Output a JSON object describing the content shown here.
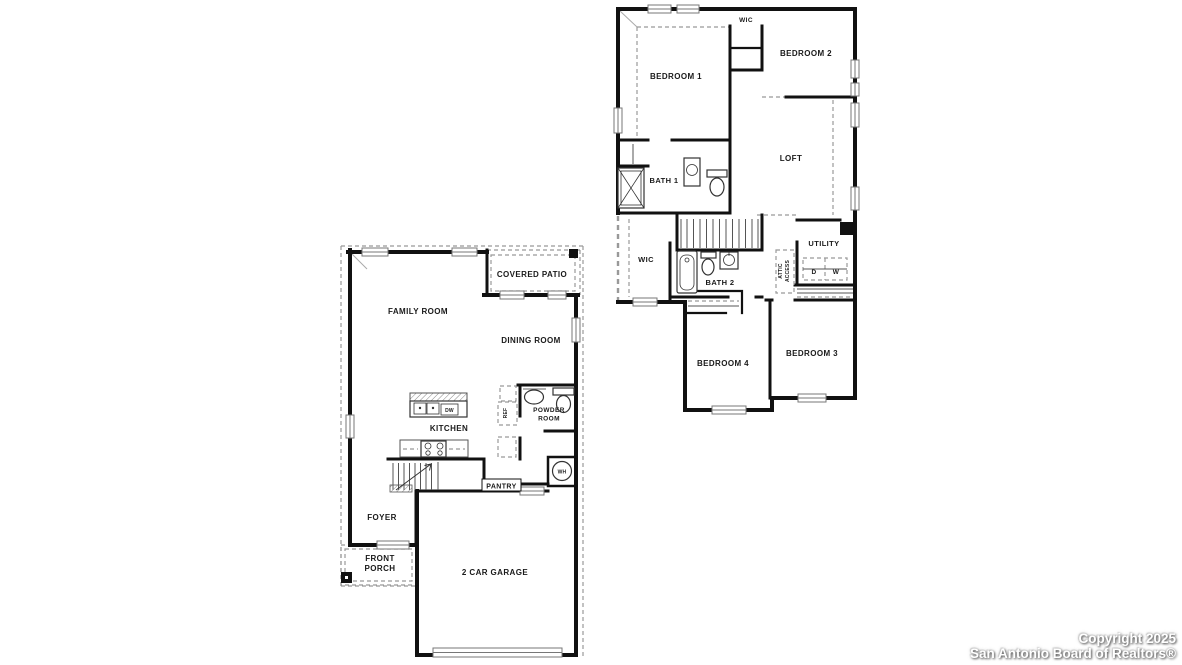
{
  "watermark": {
    "line1": "Copyright 2025",
    "line2": "San Antonio Board of Realtors®"
  },
  "colors": {
    "wall": "#111111",
    "dashed_line": "#999999",
    "label": "#1a1a1a",
    "watermark_text": "#ffffff",
    "background": "#ffffff"
  },
  "first_floor": {
    "labels": {
      "family_room": "FAMILY ROOM",
      "covered_patio": "COVERED PATIO",
      "dining_room": "DINING ROOM",
      "kitchen": "KITCHEN",
      "dw": "DW",
      "ref": "REF",
      "powder_room_line1": "POWDER",
      "powder_room_line2": "ROOM",
      "pantry": "PANTRY",
      "wh": "WH",
      "foyer": "FOYER",
      "front_porch_line1": "FRONT",
      "front_porch_line2": "PORCH",
      "garage": "2 CAR GARAGE"
    }
  },
  "second_floor": {
    "labels": {
      "bedroom1": "BEDROOM 1",
      "wic_top": "WIC",
      "bedroom2": "BEDROOM 2",
      "loft": "LOFT",
      "bath1": "BATH 1",
      "wic_left": "WIC",
      "bath2": "BATH 2",
      "attic_line1": "ATTIC",
      "attic_line2": "ACCESS",
      "utility": "UTILITY",
      "dryer": "D",
      "washer": "W",
      "bedroom3": "BEDROOM 3",
      "bedroom4": "BEDROOM 4"
    }
  }
}
